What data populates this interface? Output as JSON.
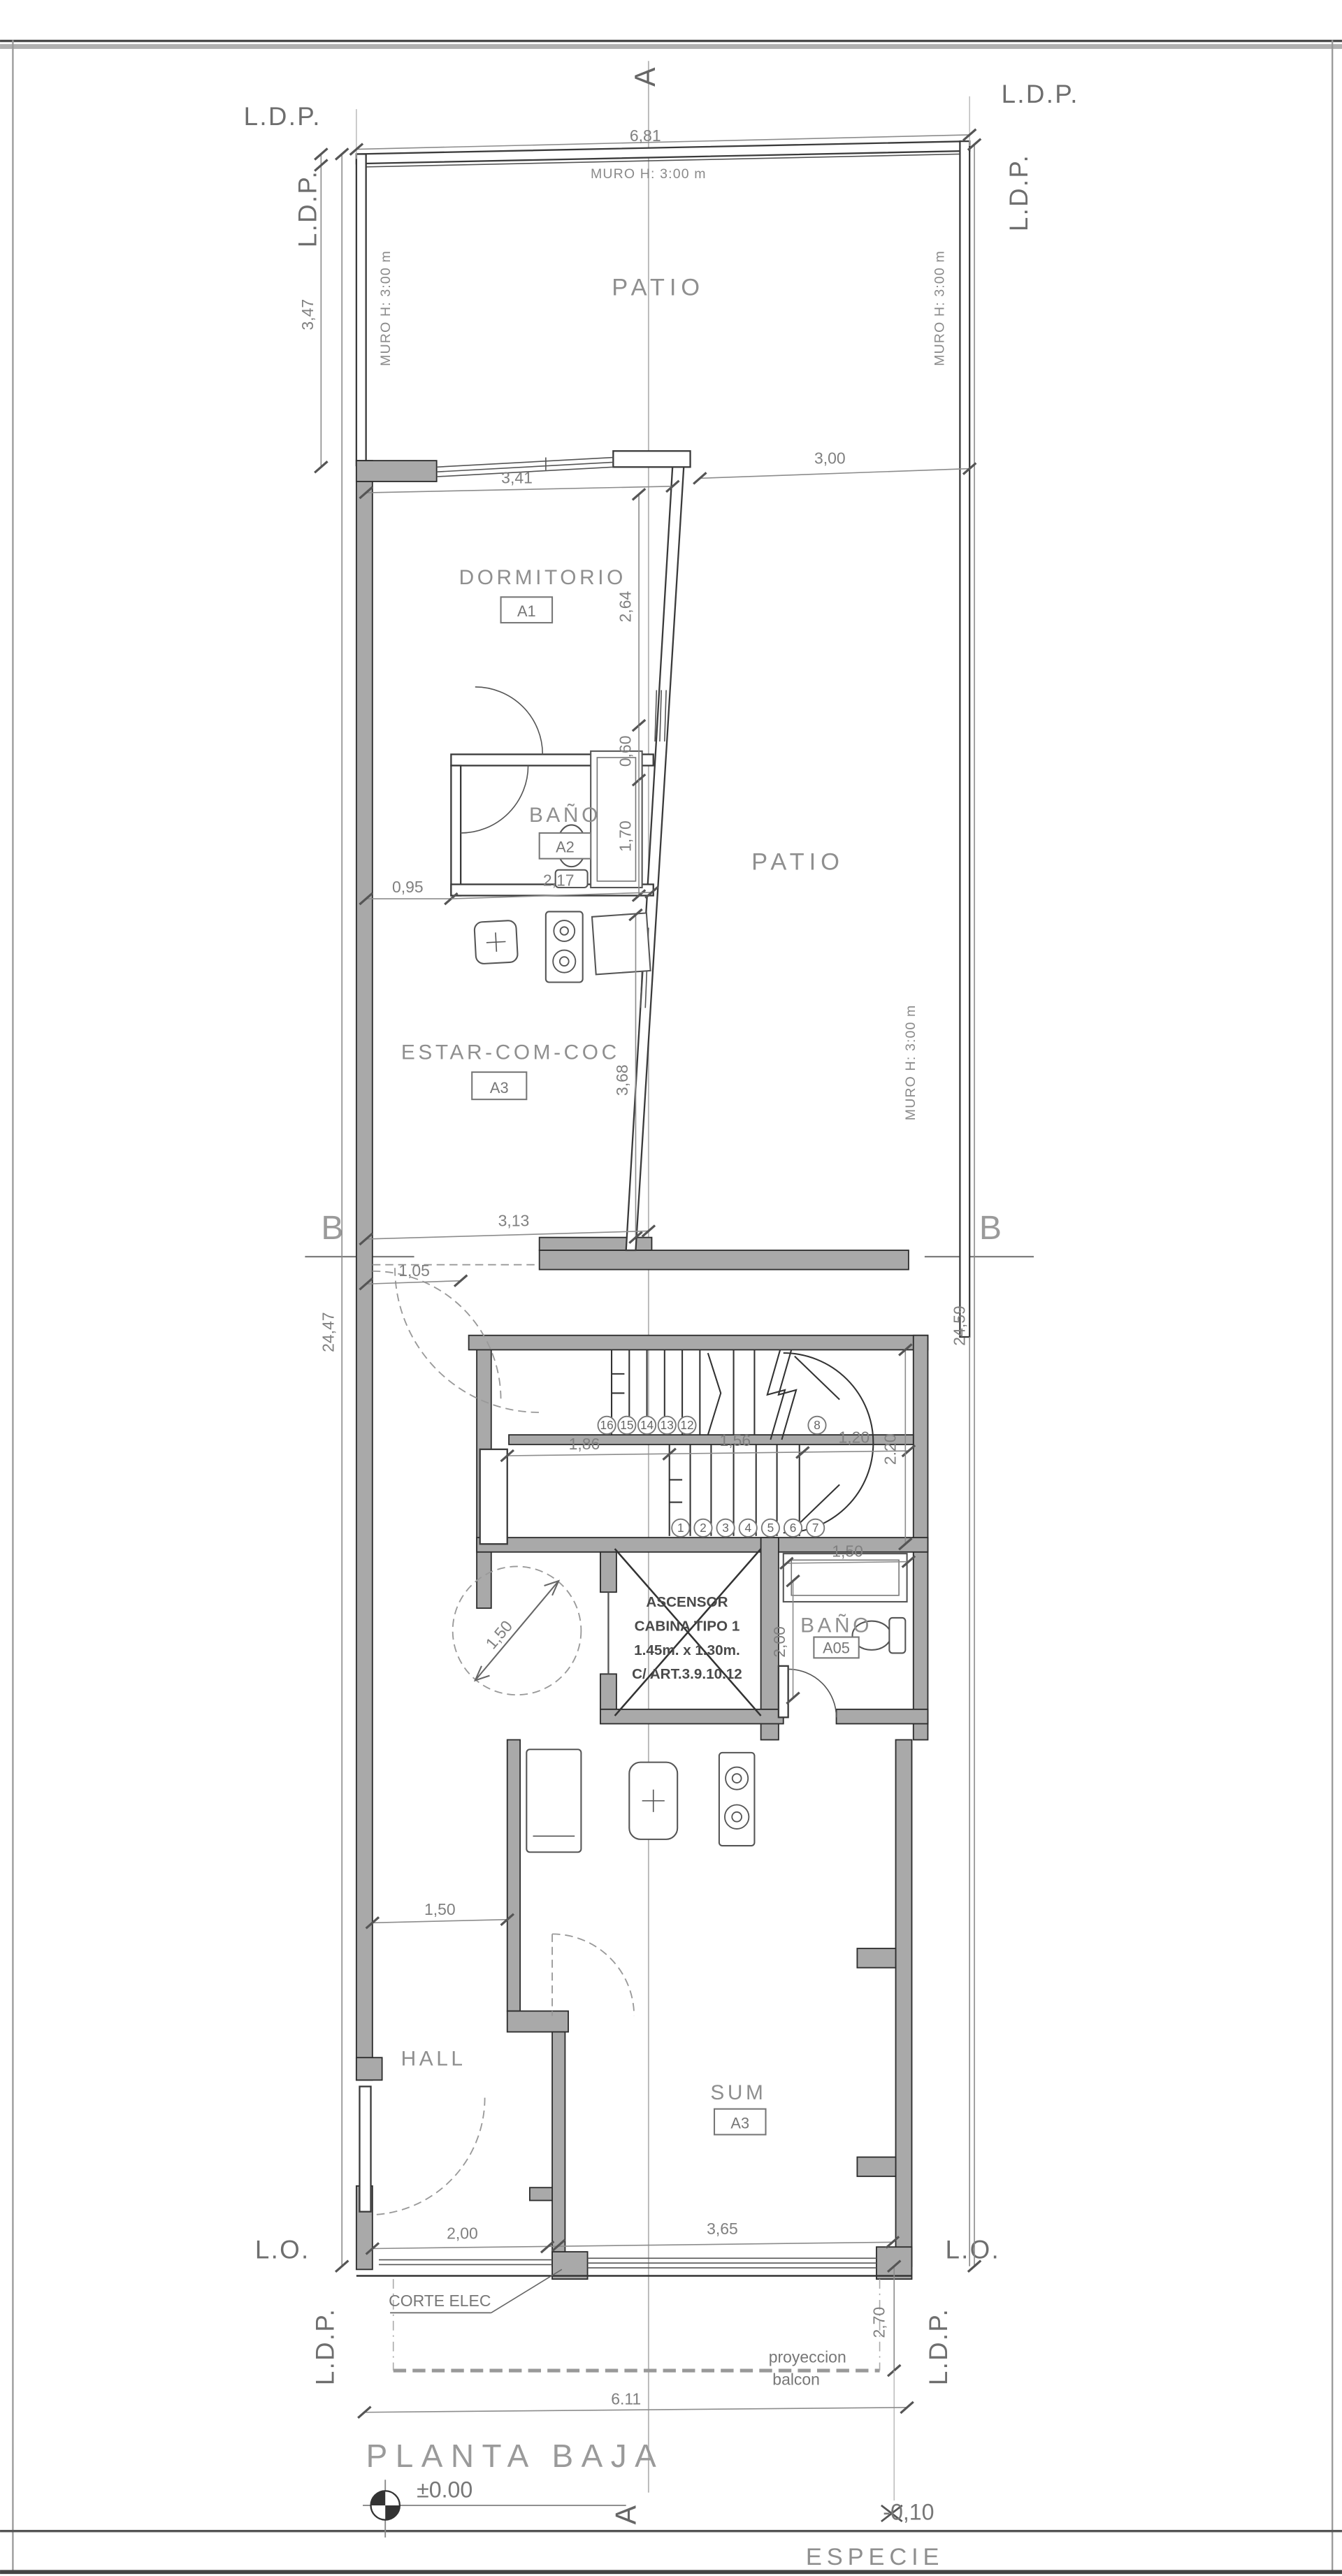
{
  "labels": {
    "ldp": "L.D.P.",
    "lo": "L.O.",
    "muro": "MURO H: 3:00 m",
    "section_a": "A",
    "section_b": "B"
  },
  "rooms": {
    "patio_upper": "PATIO",
    "patio_lower": "PATIO",
    "dormitorio": "DORMITORIO",
    "dormitorio_tag": "A1",
    "bano_a2": "BAÑO",
    "bano_a2_tag": "A2",
    "estar": "ESTAR-COM-COC",
    "estar_tag": "A3",
    "hall": "HALL",
    "sum": "SUM",
    "sum_tag": "A3",
    "bano_a05": "BAÑO",
    "bano_a05_tag": "A05"
  },
  "elevator": {
    "line1": "ASCENSOR",
    "line2": "CABINA TIPO 1",
    "line3": "1.45m. x 1.30m.",
    "line4": "C/ ART.3.9.10.12"
  },
  "stairs": {
    "lower": [
      "1",
      "2",
      "3",
      "4",
      "5",
      "6",
      "7"
    ],
    "upper": [
      "16",
      "15",
      "14",
      "13",
      "12"
    ],
    "winder": "8"
  },
  "dims": {
    "w_total": "6,81",
    "patio_depth": "3,47",
    "dorm_w": "3,41",
    "patio_w": "3,00",
    "dorm_d": "2,64",
    "win": "0,60",
    "bano_d": "1,70",
    "pass": "0,95",
    "bano_w": "2,17",
    "estar_d": "3,68",
    "lot_left": "24,47",
    "lot_right": "24,59",
    "estar_w": "3,13",
    "pass2": "1,05",
    "landing": "1,86",
    "flight": "1,56",
    "winder_w": "1,20",
    "stair_d": "2.20",
    "shower": "1,50",
    "bano2_d": "2,00",
    "turn_circle": "1,50",
    "hall_w": "1,50",
    "front_left": "2,00",
    "front_right": "3,65",
    "balcony_d": "2,70",
    "front_total": "6.11"
  },
  "annotations": {
    "corte_elec": "CORTE ELEC",
    "proyeccion": "proyeccion",
    "balcon": "balcon",
    "level_zero": "±0.00",
    "level_neg": "-0,10"
  },
  "title_block": {
    "title": "PLANTA BAJA",
    "species_label": "ESPECIE",
    "species_value": "ARBOREA"
  }
}
